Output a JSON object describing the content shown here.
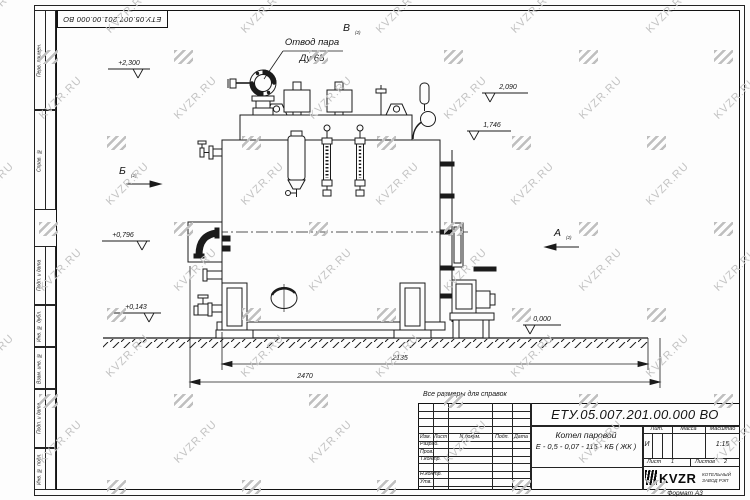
{
  "watermark": {
    "text": "KVZR.RU"
  },
  "sheet": {
    "top_stamp": "ЕТУ.05.007.201.00.000  ВО",
    "format_note": "Формат А3",
    "ref_note": "Все размеры для справок",
    "margin": {
      "perv_primen": "Перв. примен.",
      "sprav_no": "Справ. №",
      "podp_data_1": "Подп. и дата",
      "inv_dubl": "Инв. № дубл.",
      "vzam_inv": "Взам. инв. №",
      "podp_data_2": "Подп. и дата",
      "inv_podl": "Инв. № подл."
    }
  },
  "drawing": {
    "callout_line1": "Отвод пара",
    "callout_line2": "Ду 65",
    "views": {
      "b": "Б",
      "v": "В",
      "a": "А",
      "ref": "(2)"
    },
    "elevations": {
      "top": "+2,300",
      "e2090": "2,090",
      "e1746": "1,746",
      "e0796": "+0,796",
      "e0143": "+0,143",
      "zero": "0,000"
    },
    "dims": {
      "inner": "2135",
      "outer": "2470"
    }
  },
  "title_block": {
    "doc_number": "ЕТУ.05.007.201.00.000  ВО",
    "name_line1": "Котел паровой",
    "name_line2": "Е - 0,5 - 0,07 - 115 - КБ ( ЖК )",
    "cols": {
      "izm": "Изм.",
      "list": "Лист",
      "ndoc": "N докум.",
      "podp": "Подп.",
      "data": "Дата"
    },
    "rows": {
      "razrab": "Разраб.",
      "prov": "Пров.",
      "tkontr": "Т.контр.",
      "nkontr": "Н.контр.",
      "utv": "Утв."
    },
    "lit_header": "Лит.",
    "mass_header": "Масса",
    "scale_header": "Масштаб",
    "lit_value": "И",
    "scale_value": "1:15",
    "sheet_label": "Лист",
    "sheet_value": "1",
    "sheets_label": "Листов",
    "sheets_value": "2",
    "company": {
      "name": "KVZR",
      "tagline1": "КОТЕЛЬНЫЙ",
      "tagline2": "ЗАВОД РЭП"
    }
  }
}
